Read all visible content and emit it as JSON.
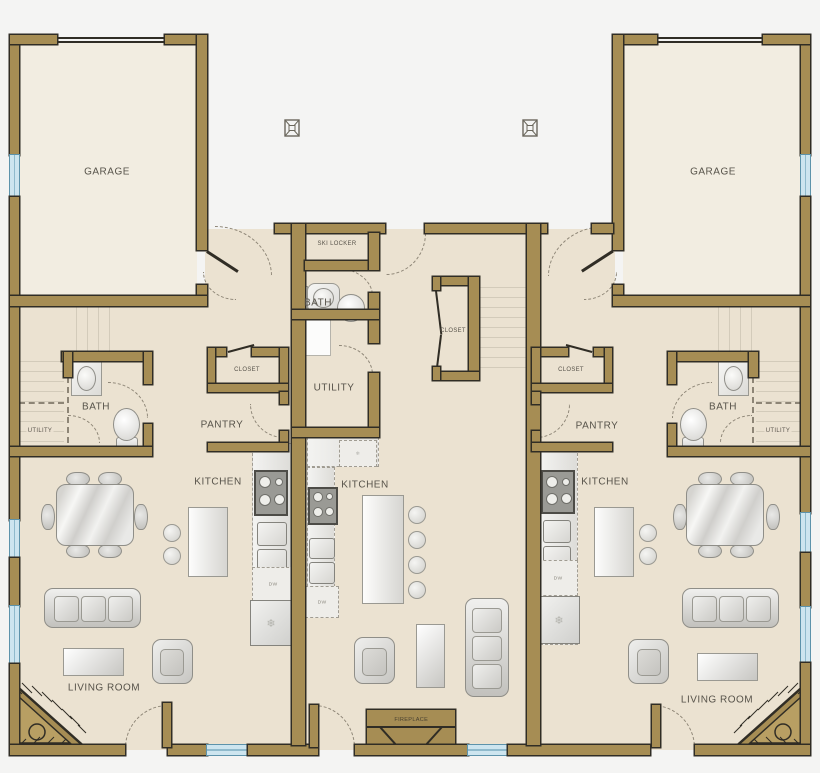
{
  "colors": {
    "background": "#f4f4f3",
    "floor": "#ebe2d1",
    "garage_floor": "#f2ede1",
    "wall_fill": "#a68d54",
    "wall_outline": "#302d25",
    "window_glass": "#cde5ef",
    "label_text": "#57534a"
  },
  "units": {
    "left": {
      "garage": "GARAGE",
      "stairs_utility": "UTILITY",
      "bath": "BATH",
      "closet": "CLOSET",
      "pantry": "PANTRY",
      "kitchen": "KITCHEN",
      "dishwasher": "DW",
      "living_room": "LIVING ROOM"
    },
    "middle": {
      "ski_locker": "SKI LOCKER",
      "bath": "BATH",
      "utility": "UTILITY",
      "closet": "CLOSET",
      "kitchen": "KITCHEN",
      "dishwasher": "DW",
      "fireplace": "FIREPLACE"
    },
    "right": {
      "garage": "GARAGE",
      "stairs_utility": "UTILITY",
      "bath": "BATH",
      "closet": "CLOSET",
      "pantry": "PANTRY",
      "kitchen": "KITCHEN",
      "dishwasher": "DW",
      "living_room": "LIVING ROOM"
    }
  }
}
